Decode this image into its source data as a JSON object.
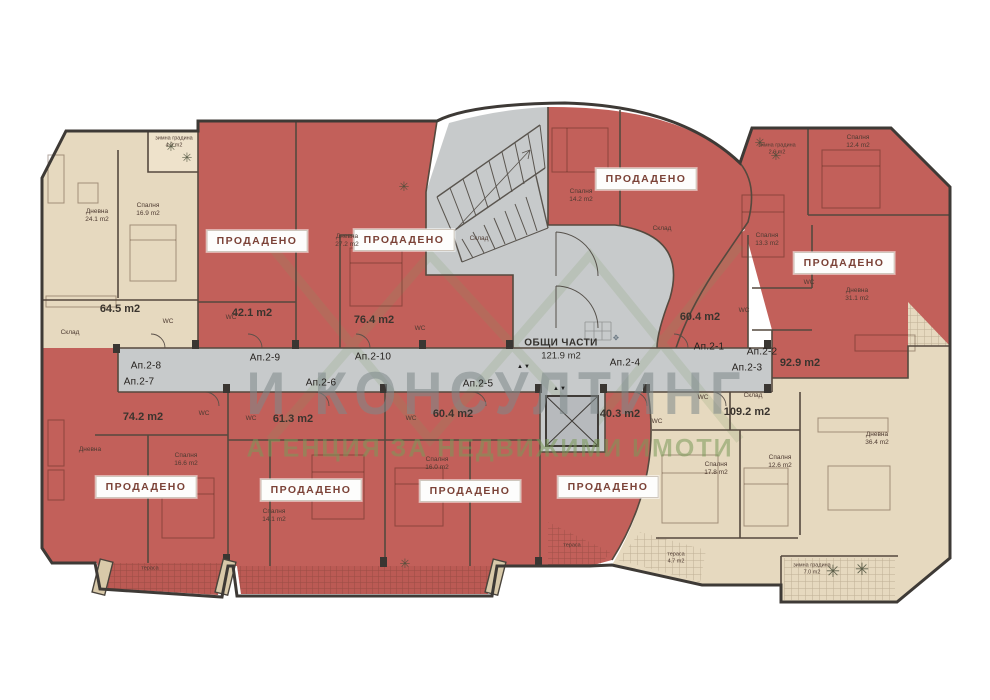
{
  "watermark": {
    "line1": "И КОНСУЛТИНГ",
    "line2": "АГЕНЦИЯ ЗА НЕДВИЖИМИ ИМОТИ"
  },
  "common": {
    "hall_title": "ОБЩИ ЧАСТИ",
    "hall_area": "121.9 m2"
  },
  "sold_badge": "ПРОДАДЕНО",
  "icons": {
    "palm": "✳",
    "lift_marker": "▲▼",
    "stamp": "❖"
  },
  "colors": {
    "sold": "#c2605a",
    "available": "#e6d9bf",
    "common": "#c7cacb",
    "badge_text": "#7b4237",
    "watermark_green": "#7d9b64"
  },
  "apartments": {
    "ap2_1": {
      "id": "Ап.2-1",
      "area": "60.4 m2",
      "status": "sold"
    },
    "ap2_2": {
      "id": "Ап.2-2",
      "area": "92.9 m2",
      "status": "sold"
    },
    "ap2_3": {
      "id": "Ап.2-3",
      "area": "109.2 m2",
      "status": "available"
    },
    "ap2_4": {
      "id": "Ап.2-4",
      "area": "40.3 m2",
      "status": "sold"
    },
    "ap2_5": {
      "id": "Ап.2-5",
      "area": "60.4 m2",
      "status": "sold"
    },
    "ap2_6": {
      "id": "Ап.2-6",
      "area": "61.3 m2",
      "status": "sold"
    },
    "ap2_7": {
      "id": "Ап.2-7",
      "area": "74.2 m2",
      "status": "sold"
    },
    "ap2_8": {
      "id": "Ап.2-8",
      "area": "64.5 m2",
      "status": "available"
    },
    "ap2_9": {
      "id": "Ап.2-9",
      "area": "42.1 m2",
      "status": "sold"
    },
    "ap2_10": {
      "id": "Ап.2-10",
      "area": "76.4 m2",
      "status": "sold"
    }
  },
  "rooms": [
    {
      "line1": "Дневна",
      "line2": "24.1 m2"
    },
    {
      "line1": "Спалня",
      "line2": "16.9 m2"
    },
    {
      "line1": "WC"
    },
    {
      "line1": "Склад"
    },
    {
      "line1": "зимна градина",
      "line2": "4.9 m2"
    },
    {
      "line1": "WC"
    },
    {
      "line1": "Дневна",
      "line2": "27.2 m2"
    },
    {
      "line1": "Склад"
    },
    {
      "line1": "WC"
    },
    {
      "line1": "Спалня",
      "line2": "14.2 m2"
    },
    {
      "line1": "Склад"
    },
    {
      "line1": "WC"
    },
    {
      "line1": "Спалня",
      "line2": "12.4 m2"
    },
    {
      "line1": "Спалня",
      "line2": "13.3 m2"
    },
    {
      "line1": "Дневна",
      "line2": "31.1 m2"
    },
    {
      "line1": "WC"
    },
    {
      "line1": "зимна градина",
      "line2": "2.6 m2"
    },
    {
      "line1": "Спалня",
      "line2": "17.8 m2"
    },
    {
      "line1": "Спалня",
      "line2": "12.6 m2"
    },
    {
      "line1": "Дневна",
      "line2": "36.4 m2"
    },
    {
      "line1": "WC"
    },
    {
      "line1": "Склад"
    },
    {
      "line1": "зимна градина",
      "line2": "7.0 m2"
    },
    {
      "line1": "тераса",
      "line2": "4.7 m2"
    },
    {
      "line1": "WC"
    },
    {
      "line1": "тераса"
    },
    {
      "line1": "Спалня",
      "line2": "16.0 m2"
    },
    {
      "line1": "WC"
    },
    {
      "line1": "Спалня",
      "line2": "14.1 m2"
    },
    {
      "line1": "WC"
    },
    {
      "line1": "Дневна"
    },
    {
      "line1": "Спалня",
      "line2": "16.6 m2"
    },
    {
      "line1": "WC"
    },
    {
      "line1": "тераса"
    }
  ]
}
